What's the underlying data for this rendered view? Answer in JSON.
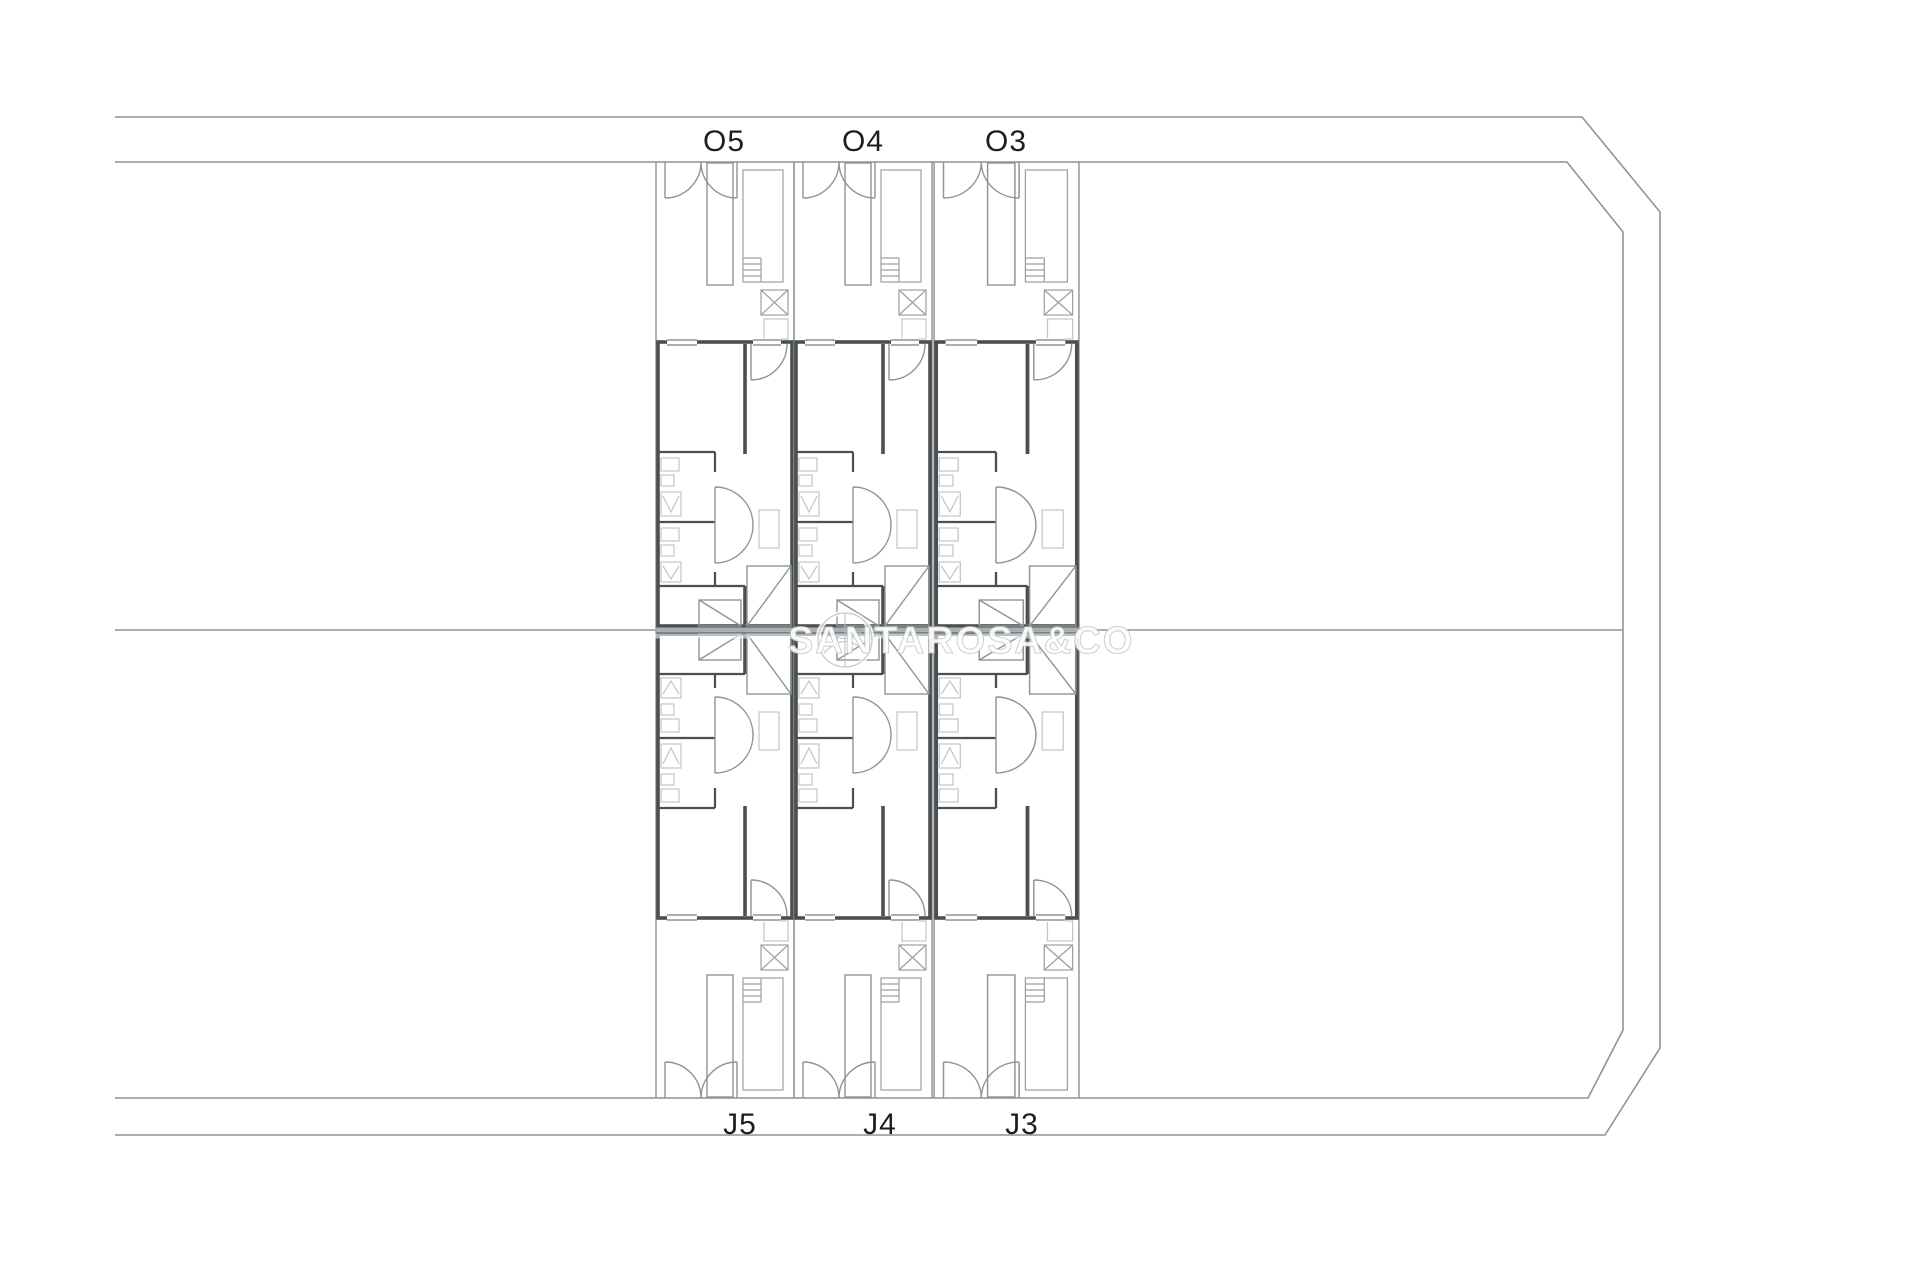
{
  "plan": {
    "units": [
      {
        "id": "O5",
        "label": "O5",
        "row": "top"
      },
      {
        "id": "O4",
        "label": "O4",
        "row": "top"
      },
      {
        "id": "O3",
        "label": "O3",
        "row": "top"
      },
      {
        "id": "J5",
        "label": "J5",
        "row": "bottom"
      },
      {
        "id": "J4",
        "label": "J4",
        "row": "bottom"
      },
      {
        "id": "J3",
        "label": "J3",
        "row": "bottom"
      }
    ]
  },
  "watermark": {
    "text": "SANTAROSA&CO",
    "logo": "circle-logo"
  },
  "colors": {
    "background": "#ffffff",
    "line": "#8f9496",
    "pool": "#9aa0a3",
    "wall": "#4b4f52",
    "fixture": "#c2c6c8",
    "label": "#1c1e20",
    "watermark_fill": "#ffffff",
    "watermark_edge": "#b9bdbf"
  }
}
